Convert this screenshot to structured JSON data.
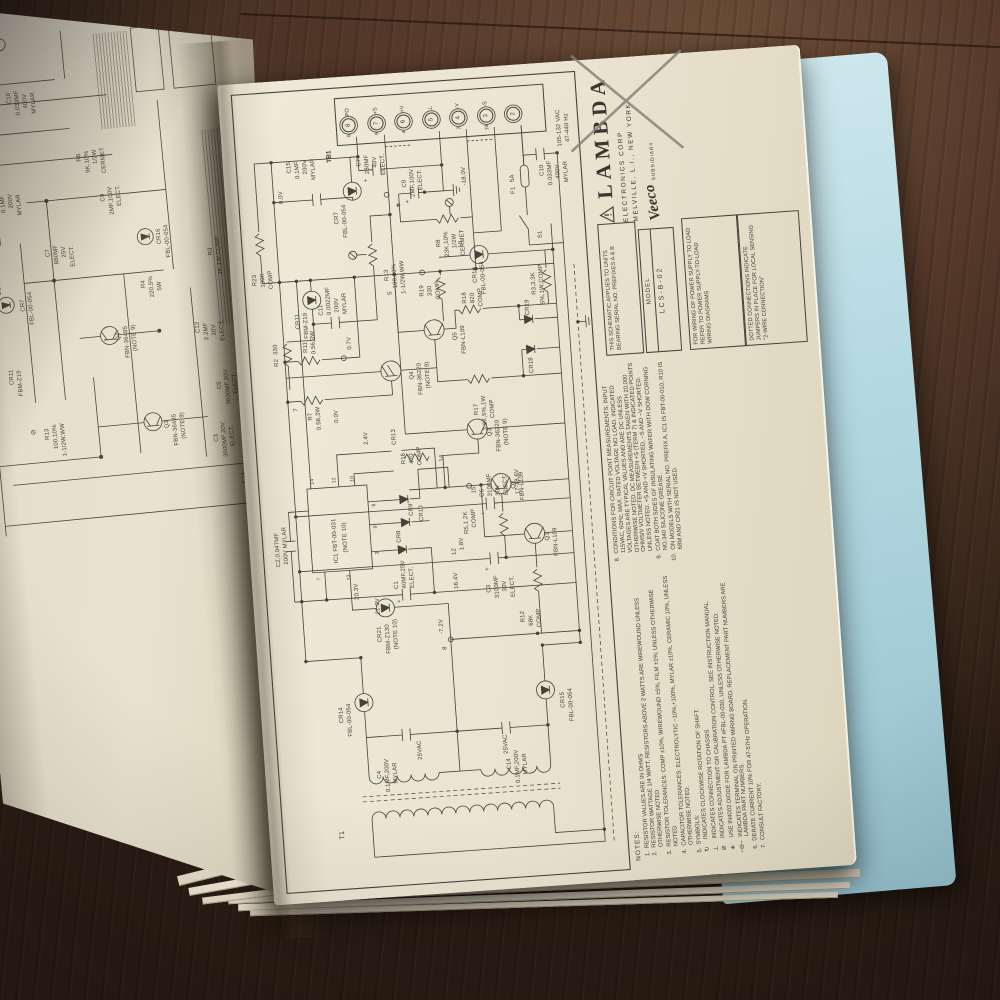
{
  "colors": {
    "page": "#ece5d2",
    "blue_page": "#b5d9e2",
    "wood": "#56392a",
    "ink": "#46413a",
    "pencil": "#85837d"
  },
  "right_page": {
    "brand": {
      "name": "LAMBDA",
      "line1": "ELECTRONICS CORP",
      "line2": "MELVILLE, L.I., NEW YORK",
      "script": "Veeco",
      "sub": "SUBSIDIARY"
    },
    "model_box": {
      "label": "MODEL",
      "value": "LCS-B-02"
    },
    "serial_note": "THIS SCHEMATIC APPLIES TO UNITS BEARING SERIAL NO. PREFIXES A & B",
    "wiring_note": "FOR WIRING OF POWER SUPPLY TO LOAD REFER TO POWER SUPPLY-TO-LOAD WIRING DIAGRAMS",
    "dotted_note": "DOTTED CONNECTIONS INDICATE JUMPERS IN PLACE FOR LOCAL SENSING \"2-WIRE CONNECTION\"",
    "input_rating": "105-132 VAC 47-440 Hz",
    "tb1": {
      "label": "TB1",
      "terminals": [
        {
          "num": "8",
          "name": "PO",
          "node": "6"
        },
        {
          "num": "7",
          "name": "+S",
          "node": "9"
        },
        {
          "num": "6",
          "name": "+V",
          "node": "4"
        },
        {
          "num": "5",
          "name": "⊥",
          "node": ""
        },
        {
          "num": "4",
          "name": "-V",
          "node": "2"
        },
        {
          "num": "3",
          "name": "-S",
          "node": "16"
        },
        {
          "num": "2",
          "name": "",
          "node": ""
        }
      ]
    },
    "notes_title": "NOTES:",
    "notes": [
      {
        "n": "1.",
        "t": "RESISTOR VALUES ARE IN OHMS"
      },
      {
        "n": "2.",
        "t": "RESISTOR WATTAGE 1/4 WATT, RESISTORS ABOVE 2 WATTS ARE WIREWOUND UNLESS OTHERWISE NOTED"
      },
      {
        "n": "3.",
        "t": "RESISTOR TOLERANCES: COMP ±10%, WIREWOUND ±5%, FILM ±1%; UNLESS OTHERWISE NOTED"
      },
      {
        "n": "4.",
        "t": "CAPACITOR TOLERANCES: ELECTROLYTIC −10%,+100%, MYLAR ±10%, CERAMIC 10%, UNLESS OTHERWISE NOTED.",
        "sub": []
      },
      {
        "n": "5.",
        "t": "SYMBOLS:",
        "sub": [
          {
            "s": "↻",
            "t": "INDICATES CLOCKWISE ROTATION OF SHAFT."
          },
          {
            "s": "⊥",
            "t": "INDICATES CONNECTION TO CHASSIS"
          },
          {
            "s": "⊘",
            "t": "INDICATES ADJUSTMENT OR CALIBRATION CONTROL. SEE INSTRUCTION MANUAL."
          },
          {
            "s": "∗",
            "t": "USE IN4002 DIODE FOR LAMBDA PT #FBL-00-030, UNLESS OTHERWISE NOTED."
          },
          {
            "s": "−⊖−",
            "t": "INDICATES TERMINAL ON PRINTED WIRING BOARD. REPLACEMENT PART NUMBERS ARE LAMBDA PART NUMBERS."
          }
        ]
      },
      {
        "n": "6.",
        "t": "DERATE CURRENT 10% FOR 47-57Hz OPERATION."
      },
      {
        "n": "7.",
        "t": "CONSULT FACTORY."
      }
    ],
    "conditions": [
      {
        "n": "8.",
        "t": "CONDITIONS FOR CIRCUIT POINT MEASUREMENTS: INPUT 115VAC, 60Hz; MAX. RATED VOLTAGE NO LOAD. INDICATED VOLTAGES ARE TYPICAL VALUES AND ARE DC UNLESS OTHERWISE NOTED. DC MEASUREMENTS TAKEN WITH 20,000 OHMS/V VOLTMETER BETWEEN +S (TERM 7) & INDICATED POINTS UNLESS NOTED. +S AND +V SHORTED, −S AND −V SHORTED."
      },
      {
        "n": "9.",
        "t": "COAT BOTH SIDES OF INSULATING WAFER WITH DOW CORNING NO.340 SILICONE GREASE."
      },
      {
        "n": "10.",
        "t": "ON MODELS WITH SERIAL NO. PREFIX A, IC1 IS FBT-00-010, R10 IS 68M AND CR21 IS NOT USED."
      }
    ],
    "labels": [
      [
        60,
        66,
        "T1",
        7
      ],
      [
        134,
        150,
        "25VAC"
      ],
      [
        134,
        236,
        "25VAC"
      ],
      [
        118,
        108,
        "C4"
      ],
      [
        104,
        116,
        "0.1MF,200V"
      ],
      [
        112,
        124,
        "MYLAR"
      ],
      [
        118,
        238,
        "C14"
      ],
      [
        104,
        246,
        "0.1MF,200V"
      ],
      [
        112,
        254,
        "MYLAR"
      ],
      [
        176,
        74,
        "CR14"
      ],
      [
        162,
        82,
        "FBL-00-054"
      ],
      [
        176,
        296,
        "CR15"
      ],
      [
        162,
        304,
        "FBL-00-054"
      ],
      [
        258,
        180,
        "-7.2V"
      ],
      [
        242,
        182,
        "8"
      ],
      [
        282,
        118,
        "21.0V"
      ],
      [
        306,
        138,
        "C1"
      ],
      [
        306,
        146,
        "40MF,25V"
      ],
      [
        306,
        154,
        "ELECT."
      ],
      [
        292,
        140,
        "+"
      ],
      [
        302,
        198,
        "16.4V"
      ],
      [
        336,
        198,
        "12"
      ],
      [
        296,
        230,
        "C3"
      ],
      [
        290,
        238,
        "3100MF"
      ],
      [
        296,
        246,
        "30V"
      ],
      [
        290,
        254,
        "ELECT."
      ],
      [
        318,
        230,
        "+"
      ],
      [
        392,
        230,
        "C6"
      ],
      [
        392,
        238,
        "3100MF"
      ],
      [
        392,
        246,
        "30V"
      ],
      [
        392,
        254,
        "ELECT."
      ],
      [
        374,
        230,
        "+"
      ],
      [
        392,
        266,
        "17-18.6V"
      ],
      [
        264,
        262,
        "R12"
      ],
      [
        260,
        270,
        "68K"
      ],
      [
        258,
        278,
        "COMP"
      ],
      [
        340,
        206,
        "1.8V"
      ],
      [
        344,
        292,
        "Q1"
      ],
      [
        328,
        300,
        "FBN-L109"
      ],
      [
        356,
        212,
        "R5,1.2K"
      ],
      [
        362,
        220,
        "COMP"
      ],
      [
        396,
        222,
        "15"
      ],
      [
        398,
        262,
        "Q2"
      ],
      [
        386,
        270,
        "FBN-L109"
      ],
      [
        452,
        242,
        "Q3"
      ],
      [
        436,
        250,
        "FBN-36220"
      ],
      [
        442,
        258,
        "(NOTE 9)"
      ],
      [
        430,
        192,
        "14"
      ],
      [
        336,
        22,
        "C2,0.047MF"
      ],
      [
        338,
        30,
        "200V MYLAR"
      ],
      [
        298,
        98,
        "20.3V"
      ],
      [
        254,
        118,
        "CR21"
      ],
      [
        242,
        126,
        "FBM-Z130"
      ],
      [
        246,
        134,
        "(NOTE 10)"
      ],
      [
        336,
        80,
        "IC1 FBT-00-031"
      ],
      [
        346,
        90,
        "(NOTE 10)"
      ],
      [
        320,
        62,
        "7",
        5
      ],
      [
        318,
        92,
        "13",
        5
      ],
      [
        416,
        62,
        "14",
        5
      ],
      [
        416,
        84,
        "12",
        5
      ],
      [
        416,
        102,
        "10",
        5
      ],
      [
        342,
        122,
        "3",
        5
      ],
      [
        368,
        122,
        "9",
        5
      ],
      [
        390,
        122,
        "8",
        5
      ],
      [
        352,
        144,
        "CR8"
      ],
      [
        378,
        158,
        "CR9"
      ],
      [
        450,
        146,
        "CR13"
      ],
      [
        372,
        168,
        "CR10"
      ],
      [
        430,
        154,
        "R16"
      ],
      [
        430,
        162,
        "470"
      ],
      [
        428,
        170,
        "COMP"
      ],
      [
        452,
        118,
        "2.4V"
      ],
      [
        476,
        90,
        "0.0V"
      ],
      [
        490,
        50,
        "7"
      ],
      [
        480,
        64,
        "R7"
      ],
      [
        470,
        72,
        "0.56,3W"
      ],
      [
        548,
        64,
        "R11"
      ],
      [
        546,
        72,
        "0.56,3W"
      ],
      [
        514,
        168,
        "Q4"
      ],
      [
        498,
        176,
        "FBN-36220"
      ],
      [
        504,
        184,
        "(NOTE 9)"
      ],
      [
        550,
        214,
        "Q5"
      ],
      [
        536,
        222,
        "FBN-L109"
      ],
      [
        596,
        184,
        "R19"
      ],
      [
        596,
        192,
        "330"
      ],
      [
        592,
        200,
        "COMP"
      ],
      [
        586,
        226,
        "R18"
      ],
      [
        586,
        234,
        "820"
      ],
      [
        582,
        242,
        "COMP"
      ],
      [
        474,
        230,
        "R17"
      ],
      [
        458,
        238,
        "3.3K,5%,1W"
      ],
      [
        470,
        246,
        "COMP"
      ],
      [
        512,
        288,
        "CR18"
      ],
      [
        570,
        288,
        "CR19"
      ],
      [
        590,
        296,
        "R3,3.3K"
      ],
      [
        580,
        304,
        "5%,1W,COMP"
      ],
      [
        606,
        238,
        "CR16"
      ],
      [
        594,
        246,
        "FBL-00-054"
      ],
      [
        642,
        226,
        "10"
      ],
      [
        600,
        152,
        "5"
      ],
      [
        618,
        18,
        "R23"
      ],
      [
        616,
        26,
        "100K"
      ],
      [
        614,
        34,
        "COMP"
      ],
      [
        536,
        34,
        "R2"
      ],
      [
        548,
        34,
        "330"
      ],
      [
        572,
        58,
        "CR11"
      ],
      [
        562,
        66,
        "FBM-Z19"
      ],
      [
        584,
        82,
        "C11"
      ],
      [
        584,
        90,
        "0.0022MF"
      ],
      [
        586,
        98,
        "200V"
      ],
      [
        584,
        106,
        "MYLAR"
      ],
      [
        548,
        108,
        "0.7V"
      ],
      [
        614,
        150,
        "R13"
      ],
      [
        606,
        158,
        "100,10%"
      ],
      [
        600,
        166,
        "1-1/2W,WW"
      ],
      [
        698,
        50,
        "0.0V"
      ],
      [
        674,
        104,
        "CR7"
      ],
      [
        660,
        112,
        "FBL-00-054"
      ],
      [
        730,
        130,
        "C7"
      ],
      [
        722,
        138,
        "280MF"
      ],
      [
        728,
        146,
        "40V"
      ],
      [
        720,
        154,
        "ELECT."
      ],
      [
        714,
        136,
        "+"
      ],
      [
        728,
        60,
        "C15"
      ],
      [
        722,
        68,
        "0.1MF"
      ],
      [
        726,
        76,
        "200V"
      ],
      [
        720,
        84,
        "MYLAR"
      ],
      [
        686,
        166,
        "∗",
        7
      ],
      [
        706,
        174,
        "C9"
      ],
      [
        696,
        182,
        "2MF,100V"
      ],
      [
        702,
        190,
        "ELECT."
      ],
      [
        690,
        176,
        "+"
      ],
      [
        644,
        204,
        "R8"
      ],
      [
        634,
        212,
        "23K,10%"
      ],
      [
        642,
        220,
        "1/2W"
      ],
      [
        634,
        228,
        "CERMET"
      ],
      [
        704,
        234,
        "-18.0V"
      ],
      [
        692,
        282,
        "F1"
      ],
      [
        704,
        282,
        "5A"
      ],
      [
        646,
        306,
        "S1"
      ],
      [
        708,
        312,
        "C10"
      ],
      [
        698,
        320,
        "0.033MF"
      ],
      [
        704,
        328,
        "400V"
      ],
      [
        700,
        336,
        "MYLAR"
      ],
      [
        736,
        332,
        "105-132 VAC"
      ],
      [
        740,
        340,
        "47-440 Hz"
      ]
    ]
  },
  "left_page": {
    "labels": [
      [
        520,
        36,
        "CR11"
      ],
      [
        508,
        44,
        "FBM-Z19"
      ],
      [
        468,
        52,
        "⊘",
        7
      ],
      [
        462,
        66,
        "R13"
      ],
      [
        452,
        74,
        "100,10%"
      ],
      [
        444,
        82,
        "1-1/2W,WW"
      ],
      [
        592,
        54,
        "CR7"
      ],
      [
        578,
        62,
        "FBL-00-054"
      ],
      [
        644,
        84,
        "C7"
      ],
      [
        636,
        92,
        "880MF"
      ],
      [
        642,
        100,
        "25V"
      ],
      [
        632,
        108,
        "ELECT."
      ],
      [
        698,
        36,
        "C15"
      ],
      [
        692,
        44,
        "0.1MF"
      ],
      [
        696,
        52,
        "200V"
      ],
      [
        688,
        60,
        "MYLAR"
      ],
      [
        694,
        144,
        "C9"
      ],
      [
        680,
        152,
        "2MF,100V"
      ],
      [
        688,
        160,
        "ELECT."
      ],
      [
        736,
        124,
        "R8"
      ],
      [
        724,
        132,
        "9K,10%"
      ],
      [
        732,
        140,
        "1/2W"
      ],
      [
        722,
        148,
        "CERMET"
      ],
      [
        758,
        26,
        "R11"
      ],
      [
        746,
        34,
        "0.25,5%"
      ],
      [
        754,
        42,
        "5W"
      ],
      [
        800,
        60,
        "C10"
      ],
      [
        788,
        68,
        "0.033MF"
      ],
      [
        794,
        76,
        "400V"
      ],
      [
        788,
        84,
        "MYLAR"
      ],
      [
        554,
        146,
        "Q4"
      ],
      [
        536,
        154,
        "FBN-36485"
      ],
      [
        542,
        162,
        "(NOTE 9)"
      ],
      [
        462,
        186,
        "Q3"
      ],
      [
        444,
        194,
        "FBN-36485"
      ],
      [
        450,
        202,
        "(NOTE 9)"
      ],
      [
        604,
        176,
        "R4"
      ],
      [
        594,
        184,
        "220,5%"
      ],
      [
        600,
        192,
        "5W"
      ],
      [
        646,
        196,
        "CR16"
      ],
      [
        632,
        204,
        "FBL-00-054"
      ],
      [
        554,
        226,
        "C12"
      ],
      [
        546,
        234,
        "2.2MF"
      ],
      [
        550,
        242,
        "20V"
      ],
      [
        544,
        250,
        "ELECT."
      ],
      [
        630,
        246,
        "R3"
      ],
      [
        610,
        254,
        "1K,1W,COMP"
      ],
      [
        444,
        234,
        "C3"
      ],
      [
        428,
        242,
        "3600MF,20V"
      ],
      [
        438,
        250,
        "ELECT."
      ],
      [
        496,
        242,
        "C6"
      ],
      [
        480,
        250,
        "3600MF,20V"
      ],
      [
        490,
        258,
        "ELECT."
      ],
      [
        524,
        272,
        "-7.6V"
      ],
      [
        546,
        280,
        "8"
      ],
      [
        400,
        258,
        "C14"
      ],
      [
        388,
        266,
        "0.1MF,200V"
      ],
      [
        396,
        274,
        "MYLAR"
      ],
      [
        372,
        284,
        "CR1"
      ],
      [
        618,
        16,
        "R23"
      ],
      [
        612,
        24,
        "100K"
      ],
      [
        610,
        32,
        "COMP"
      ]
    ]
  }
}
